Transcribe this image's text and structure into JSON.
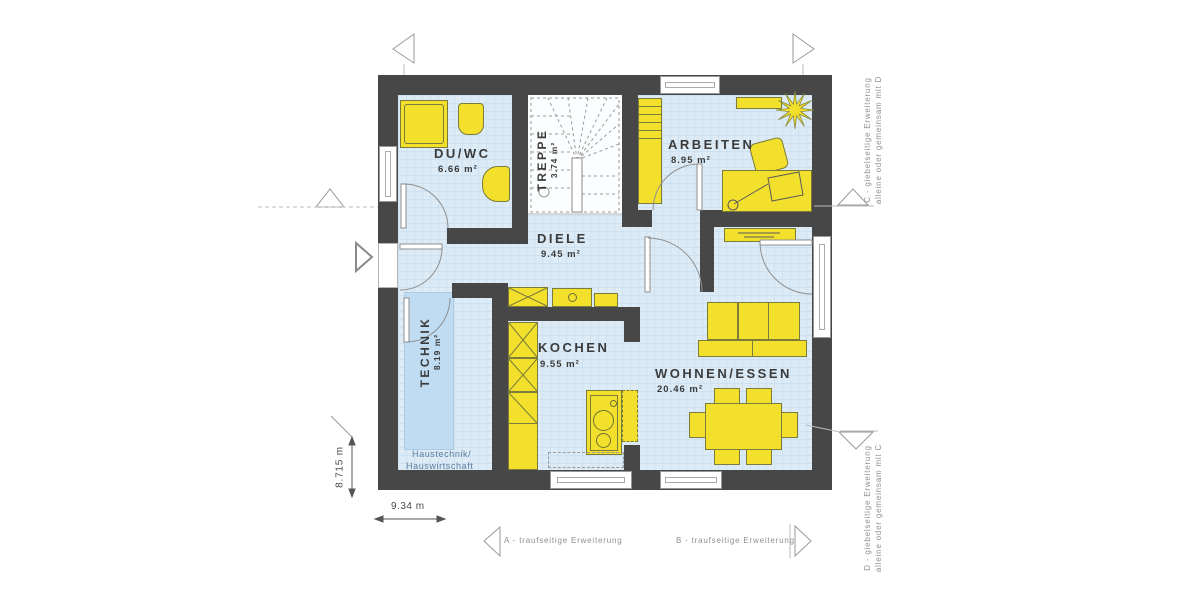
{
  "rooms": {
    "duwc": {
      "label": "DU/WC",
      "area": "6.66 m²"
    },
    "treppe": {
      "label": "TREPPE",
      "area": "3.74 m²"
    },
    "arbeiten": {
      "label": "ARBEITEN",
      "area": "8.95 m²"
    },
    "diele": {
      "label": "DIELE",
      "area": "9.45 m²"
    },
    "technik": {
      "label": "TECHNIK",
      "area": "8.19 m²",
      "note1": "Haustechnik/",
      "note2": "Hauswirtschaft"
    },
    "kochen": {
      "label": "KOCHEN",
      "area": "9.55 m²"
    },
    "wohnen": {
      "label": "WOHNEN/ESSEN",
      "area": "20.46 m²"
    }
  },
  "dimensions": {
    "horizontal": "9.34 m",
    "vertical": "8.715 m"
  },
  "annotations": {
    "a": "A - traufseitige Erweiterung",
    "b": "B - traufseitige Erweiterung",
    "c1": "C - giebelseitige Erweiterung",
    "c2": "alleine oder gemeinsam mit D",
    "d1": "D - giebelseitige Erweiterung",
    "d2": "alleine oder gemeinsam mit C"
  },
  "colors": {
    "wall": "#474747",
    "floor": "#dcebf6",
    "floor_grid": "#cde1f0",
    "furniture": "#f3e02c",
    "furniture_outline": "#7c7c3a",
    "technik_zone": "#c0dcf2",
    "stair_floor": "#fbfdfe",
    "label_text": "#3b3b3b",
    "note_text": "#5d7da0",
    "annotation_text": "#8f8f8f"
  }
}
